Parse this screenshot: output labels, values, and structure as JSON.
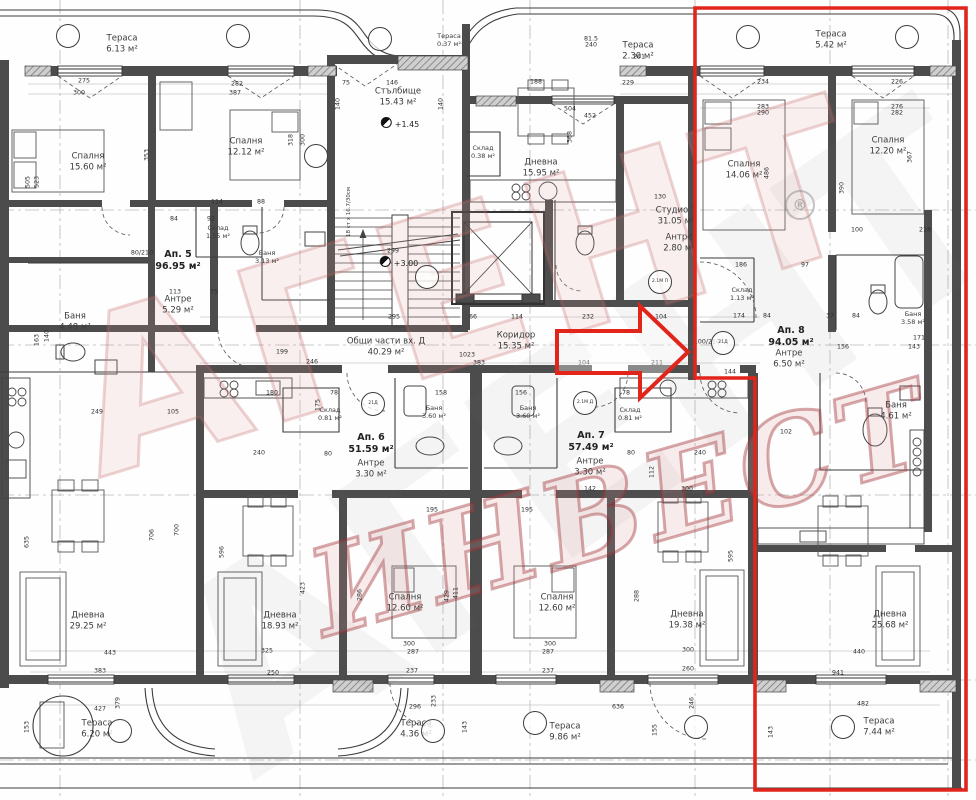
{
  "watermark": {
    "line1": "АГЕНТ",
    "line2": "ИНВЕСТ",
    "registered": "®"
  },
  "highlight": {
    "color": "#e1251b",
    "outline_points": "695,8 966,8 966,790 755,790 755,378 695,378",
    "arrow_points": "557,331 640,331 640,306 688,352 640,398 640,373 557,373"
  },
  "rooms": [
    {
      "name": "Тераса",
      "area": "6.13 м²",
      "x": 122,
      "y": 44
    },
    {
      "name": "Спалня",
      "area": "15.60 м²",
      "x": 88,
      "y": 162
    },
    {
      "name": "Спалня",
      "area": "12.12 м²",
      "x": 246,
      "y": 147
    },
    {
      "name": "Стълбище",
      "area": "15.43 м²",
      "x": 398,
      "y": 97
    },
    {
      "name": "Тераса",
      "area": "0.37 м²",
      "x": 449,
      "y": 40,
      "cls": "small"
    },
    {
      "name": "Тераса",
      "area": "2.30 м²",
      "x": 638,
      "y": 51
    },
    {
      "name": "Склад",
      "area": "0.38 м²",
      "x": 483,
      "y": 152,
      "cls": "small"
    },
    {
      "name": "Дневна",
      "area": "15.95 м²",
      "x": 541,
      "y": 168
    },
    {
      "name": "Студио 1",
      "area": "31.05 м²",
      "x": 676,
      "y": 216
    },
    {
      "name": "Антре",
      "area": "2.80 м²",
      "x": 679,
      "y": 243
    },
    {
      "name": "Спалня",
      "area": "14.06 м²",
      "x": 744,
      "y": 170
    },
    {
      "name": "Спалня",
      "area": "12.20 м²",
      "x": 888,
      "y": 146
    },
    {
      "name": "Ап. 5",
      "area": "96.95 м²",
      "x": 178,
      "y": 261,
      "cls": "apt"
    },
    {
      "name": "Склад",
      "area": "1.35 м²",
      "x": 218,
      "y": 232,
      "cls": "small"
    },
    {
      "name": "Баня",
      "area": "3.13 м²",
      "x": 267,
      "y": 257,
      "cls": "small"
    },
    {
      "name": "Антре",
      "area": "5.29 м²",
      "x": 178,
      "y": 305
    },
    {
      "name": "Баня",
      "area": "4.48 м²",
      "x": 75,
      "y": 322
    },
    {
      "name": "Общи части вх. Д",
      "area": "40.29 м²",
      "x": 386,
      "y": 347
    },
    {
      "name": "Коридор",
      "area": "15.35 м²",
      "x": 516,
      "y": 341
    },
    {
      "name": "Склад",
      "area": "1.13 м²",
      "x": 742,
      "y": 294,
      "cls": "small"
    },
    {
      "name": "Ап. 8",
      "area": "94.05 м²",
      "x": 791,
      "y": 337,
      "cls": "apt"
    },
    {
      "name": "Антре",
      "area": "6.50 м²",
      "x": 789,
      "y": 359
    },
    {
      "name": "Баня",
      "area": "3.58 м²",
      "x": 913,
      "y": 318,
      "cls": "small"
    },
    {
      "name": "Баня",
      "area": "4.61 м²",
      "x": 896,
      "y": 411
    },
    {
      "name": "Склад",
      "area": "0.81 м²",
      "x": 330,
      "y": 414,
      "cls": "small"
    },
    {
      "name": "Ап. 6",
      "area": "51.59 м²",
      "x": 371,
      "y": 444,
      "cls": "apt"
    },
    {
      "name": "Антре",
      "area": "3.30 м²",
      "x": 371,
      "y": 469
    },
    {
      "name": "Баня",
      "area": "3.60 м²",
      "x": 434,
      "y": 412,
      "cls": "small"
    },
    {
      "name": "Баня",
      "area": "3.60 м²",
      "x": 528,
      "y": 412,
      "cls": "small"
    },
    {
      "name": "Ап. 7",
      "area": "57.49 м²",
      "x": 591,
      "y": 442,
      "cls": "apt"
    },
    {
      "name": "Антре",
      "area": "3.30 м²",
      "x": 590,
      "y": 467
    },
    {
      "name": "Склад",
      "area": "0.81 м²",
      "x": 630,
      "y": 414,
      "cls": "small"
    },
    {
      "name": "Дневна",
      "area": "29.25 м²",
      "x": 88,
      "y": 621
    },
    {
      "name": "Дневна",
      "area": "18.93 м²",
      "x": 280,
      "y": 621
    },
    {
      "name": "Спалня",
      "area": "12.60 м²",
      "x": 405,
      "y": 603
    },
    {
      "name": "Спалня",
      "area": "12.60 м²",
      "x": 557,
      "y": 603
    },
    {
      "name": "Дневна",
      "area": "19.38 м²",
      "x": 687,
      "y": 620
    },
    {
      "name": "Дневна",
      "area": "25.68 м²",
      "x": 890,
      "y": 620
    },
    {
      "name": "Тераса",
      "area": "6.20 м²",
      "x": 97,
      "y": 729
    },
    {
      "name": "Тераса",
      "area": "4.36 м²",
      "x": 416,
      "y": 729
    },
    {
      "name": "Тераса",
      "area": "9.86 м²",
      "x": 565,
      "y": 732
    },
    {
      "name": "Тераса",
      "area": "7.44 м²",
      "x": 879,
      "y": 727
    },
    {
      "name": "Тераса",
      "area": "5.42 м²",
      "x": 831,
      "y": 40
    }
  ],
  "levels": [
    {
      "t": "+1.45",
      "x": 400,
      "y": 123
    },
    {
      "t": "+3.00",
      "x": 399,
      "y": 262
    }
  ],
  "stair_note": {
    "t": "18 ст x 16.7/30см",
    "x": 349,
    "y": 212
  },
  "dims": [
    {
      "t": "275",
      "x": 84,
      "y": 81
    },
    {
      "t": "300",
      "x": 79,
      "y": 93
    },
    {
      "t": "282",
      "x": 237,
      "y": 84
    },
    {
      "t": "387",
      "x": 235,
      "y": 93
    },
    {
      "t": "318",
      "x": 291,
      "y": 140,
      "v": 1
    },
    {
      "t": "300",
      "x": 303,
      "y": 140,
      "v": 1
    },
    {
      "t": "523",
      "x": 37,
      "y": 182,
      "v": 1
    },
    {
      "t": "505",
      "x": 28,
      "y": 182,
      "v": 1
    },
    {
      "t": "353",
      "x": 147,
      "y": 155,
      "v": 1
    },
    {
      "t": "114",
      "x": 217,
      "y": 202
    },
    {
      "t": "88",
      "x": 261,
      "y": 202
    },
    {
      "t": "84",
      "x": 174,
      "y": 219
    },
    {
      "t": "92",
      "x": 211,
      "y": 219
    },
    {
      "t": "113",
      "x": 175,
      "y": 292
    },
    {
      "t": "75",
      "x": 214,
      "y": 292
    },
    {
      "t": "80/210",
      "x": 142,
      "y": 253
    },
    {
      "t": "140",
      "x": 47,
      "y": 336,
      "v": 1
    },
    {
      "t": "163",
      "x": 37,
      "y": 340,
      "v": 1
    },
    {
      "t": "249",
      "x": 97,
      "y": 412
    },
    {
      "t": "105",
      "x": 173,
      "y": 412
    },
    {
      "t": "140",
      "x": 338,
      "y": 104,
      "v": 1
    },
    {
      "t": "140",
      "x": 441,
      "y": 104,
      "v": 1
    },
    {
      "t": "75",
      "x": 346,
      "y": 83
    },
    {
      "t": "146",
      "x": 392,
      "y": 83
    },
    {
      "t": "295",
      "x": 394,
      "y": 317
    },
    {
      "t": "299",
      "x": 393,
      "y": 251
    },
    {
      "t": "66",
      "x": 473,
      "y": 317
    },
    {
      "t": "114",
      "x": 517,
      "y": 317
    },
    {
      "t": "232",
      "x": 588,
      "y": 317
    },
    {
      "t": "104",
      "x": 661,
      "y": 317
    },
    {
      "t": "104",
      "x": 584,
      "y": 363
    },
    {
      "t": "211",
      "x": 657,
      "y": 363
    },
    {
      "t": "1023",
      "x": 467,
      "y": 355
    },
    {
      "t": "383",
      "x": 479,
      "y": 363
    },
    {
      "t": "188",
      "x": 536,
      "y": 82
    },
    {
      "t": "504",
      "x": 570,
      "y": 109
    },
    {
      "t": "452",
      "x": 590,
      "y": 116
    },
    {
      "t": "368",
      "x": 570,
      "y": 137,
      "v": 1
    },
    {
      "t": "81.5",
      "x": 591,
      "y": 39
    },
    {
      "t": "240",
      "x": 591,
      "y": 45
    },
    {
      "t": "261",
      "x": 639,
      "y": 57
    },
    {
      "t": "229",
      "x": 628,
      "y": 83
    },
    {
      "t": "130",
      "x": 660,
      "y": 197
    },
    {
      "t": "234",
      "x": 763,
      "y": 82
    },
    {
      "t": "226",
      "x": 897,
      "y": 82
    },
    {
      "t": "283",
      "x": 763,
      "y": 107
    },
    {
      "t": "290",
      "x": 763,
      "y": 113
    },
    {
      "t": "276",
      "x": 897,
      "y": 107
    },
    {
      "t": "282",
      "x": 897,
      "y": 113
    },
    {
      "t": "486",
      "x": 767,
      "y": 173,
      "v": 1
    },
    {
      "t": "390",
      "x": 842,
      "y": 188,
      "v": 1
    },
    {
      "t": "367",
      "x": 910,
      "y": 157,
      "v": 1
    },
    {
      "t": "100",
      "x": 857,
      "y": 230
    },
    {
      "t": "218",
      "x": 925,
      "y": 230
    },
    {
      "t": "186",
      "x": 741,
      "y": 265
    },
    {
      "t": "97",
      "x": 805,
      "y": 265
    },
    {
      "t": "174",
      "x": 739,
      "y": 316
    },
    {
      "t": "84",
      "x": 767,
      "y": 316
    },
    {
      "t": "37",
      "x": 830,
      "y": 316
    },
    {
      "t": "84",
      "x": 856,
      "y": 316
    },
    {
      "t": "156",
      "x": 843,
      "y": 347
    },
    {
      "t": "143",
      "x": 914,
      "y": 347
    },
    {
      "t": "171",
      "x": 919,
      "y": 338
    },
    {
      "t": "158",
      "x": 441,
      "y": 393
    },
    {
      "t": "156",
      "x": 521,
      "y": 393
    },
    {
      "t": "180",
      "x": 272,
      "y": 393
    },
    {
      "t": "78",
      "x": 334,
      "y": 393
    },
    {
      "t": "78",
      "x": 626,
      "y": 393
    },
    {
      "t": "240",
      "x": 259,
      "y": 453
    },
    {
      "t": "80",
      "x": 328,
      "y": 454
    },
    {
      "t": "240",
      "x": 700,
      "y": 453
    },
    {
      "t": "80",
      "x": 631,
      "y": 453
    },
    {
      "t": "142",
      "x": 590,
      "y": 489
    },
    {
      "t": "300",
      "x": 687,
      "y": 489
    },
    {
      "t": "112",
      "x": 652,
      "y": 472,
      "v": 1
    },
    {
      "t": "102",
      "x": 786,
      "y": 432
    },
    {
      "t": "595",
      "x": 731,
      "y": 556,
      "v": 1
    },
    {
      "t": "706",
      "x": 152,
      "y": 535,
      "v": 1
    },
    {
      "t": "700",
      "x": 177,
      "y": 530,
      "v": 1
    },
    {
      "t": "635",
      "x": 27,
      "y": 542,
      "v": 1
    },
    {
      "t": "596",
      "x": 222,
      "y": 552,
      "v": 1
    },
    {
      "t": "423",
      "x": 303,
      "y": 588,
      "v": 1
    },
    {
      "t": "443",
      "x": 110,
      "y": 653
    },
    {
      "t": "383",
      "x": 100,
      "y": 671
    },
    {
      "t": "325",
      "x": 267,
      "y": 651
    },
    {
      "t": "250",
      "x": 273,
      "y": 673
    },
    {
      "t": "195",
      "x": 432,
      "y": 510
    },
    {
      "t": "195",
      "x": 527,
      "y": 510
    },
    {
      "t": "287",
      "x": 413,
      "y": 652
    },
    {
      "t": "300",
      "x": 409,
      "y": 644
    },
    {
      "t": "237",
      "x": 412,
      "y": 671
    },
    {
      "t": "287",
      "x": 548,
      "y": 652
    },
    {
      "t": "300",
      "x": 550,
      "y": 644
    },
    {
      "t": "237",
      "x": 548,
      "y": 671
    },
    {
      "t": "286",
      "x": 360,
      "y": 595,
      "v": 1
    },
    {
      "t": "288",
      "x": 637,
      "y": 596,
      "v": 1
    },
    {
      "t": "429",
      "x": 447,
      "y": 596,
      "v": 1
    },
    {
      "t": "411",
      "x": 456,
      "y": 593,
      "v": 1
    },
    {
      "t": "440",
      "x": 859,
      "y": 652
    },
    {
      "t": "941",
      "x": 838,
      "y": 673
    },
    {
      "t": "300",
      "x": 688,
      "y": 650
    },
    {
      "t": "260",
      "x": 688,
      "y": 669
    },
    {
      "t": "427",
      "x": 100,
      "y": 709
    },
    {
      "t": "296",
      "x": 415,
      "y": 707
    },
    {
      "t": "636",
      "x": 618,
      "y": 707
    },
    {
      "t": "482",
      "x": 863,
      "y": 704
    },
    {
      "t": "143",
      "x": 465,
      "y": 727,
      "v": 1
    },
    {
      "t": "153",
      "x": 27,
      "y": 727,
      "v": 1
    },
    {
      "t": "143",
      "x": 771,
      "y": 732,
      "v": 1
    },
    {
      "t": "155",
      "x": 655,
      "y": 730,
      "v": 1
    },
    {
      "t": "379",
      "x": 118,
      "y": 703,
      "v": 1
    },
    {
      "t": "233",
      "x": 434,
      "y": 701,
      "v": 1
    },
    {
      "t": "246",
      "x": 692,
      "y": 703,
      "v": 1
    },
    {
      "t": "199",
      "x": 282,
      "y": 352
    },
    {
      "t": "246",
      "x": 312,
      "y": 362
    },
    {
      "t": "175",
      "x": 318,
      "y": 405,
      "v": 1
    },
    {
      "t": "144",
      "x": 730,
      "y": 372
    },
    {
      "t": "100/210",
      "x": 707,
      "y": 342
    }
  ],
  "tags": [
    {
      "t": "",
      "x": 68,
      "y": 36
    },
    {
      "t": "",
      "x": 238,
      "y": 36
    },
    {
      "t": "",
      "x": 380,
      "y": 39
    },
    {
      "t": "",
      "x": 748,
      "y": 37
    },
    {
      "t": "",
      "x": 907,
      "y": 37
    },
    {
      "t": "",
      "x": 120,
      "y": 731
    },
    {
      "t": "",
      "x": 433,
      "y": 731
    },
    {
      "t": "",
      "x": 535,
      "y": 723
    },
    {
      "t": "",
      "x": 696,
      "y": 727
    },
    {
      "t": "",
      "x": 843,
      "y": 727
    },
    {
      "t": "2.1М П",
      "x": 660,
      "y": 282
    },
    {
      "t": "21Д",
      "x": 723,
      "y": 343
    },
    {
      "t": "21Д",
      "x": 373,
      "y": 404
    },
    {
      "t": "2.1М Д",
      "x": 585,
      "y": 403
    },
    {
      "t": "",
      "x": 316,
      "y": 156
    },
    {
      "t": "",
      "x": 427,
      "y": 277
    }
  ]
}
